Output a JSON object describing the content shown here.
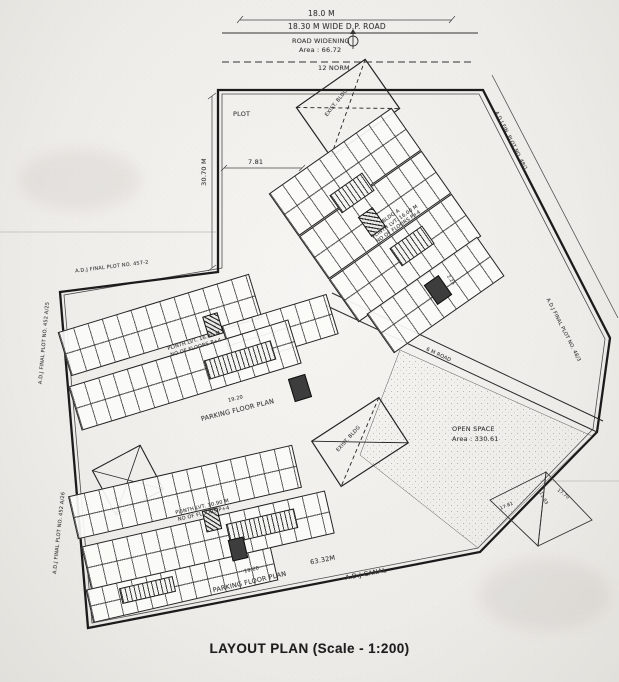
{
  "title": "LAYOUT PLAN (Scale - 1:200)",
  "roads": {
    "top_dim": "18.0 M",
    "dp_road": "18.30 M WIDE D.P. ROAD",
    "widening": "ROAD WIDENING",
    "widening_area": "Area : 66.72",
    "setback": "12 NORM",
    "internal": "6 M ROAD",
    "canal": "A.D.J CANAL",
    "canal_dim": "63.32M"
  },
  "plot": {
    "label": "PLOT",
    "west_dim": "30.70 M",
    "offset_dim": "7.81",
    "side_dim": "2.25"
  },
  "buildings": {
    "a": {
      "name": "BLDG A",
      "plinth": "PLINTH LVT. 16.00 M",
      "floors": "NO OF FLOORS P+4"
    },
    "b": {
      "plinth": "PLINTH LVT. 16.00 M",
      "floors": "NO OF FLOORS P+4"
    },
    "c": {
      "plinth": "PLINTH LVT. 10.90 M",
      "floors": "NO OF FLOORS P+4"
    }
  },
  "parking": {
    "label": "PARKING FLOOR PLAN",
    "dim": "19.20"
  },
  "open_space": {
    "label": "OPEN SPACE",
    "area": "Area : 330.61"
  },
  "existing": {
    "label": "EXIST. BLDG"
  },
  "adjacent": {
    "left_top": "A.D.J FINAL PLOT NO. 457-2",
    "left_mid": "A.D.J FINAL PLOT NO. 452 A/25",
    "left_bottom": "A.D.J FINAL PLOT NO. 452 A/26",
    "right_top": "A.D.J FIN. PLOT NO. 48/1",
    "right_mid": "A.D.J FINAL PLOT NO. 48/3"
  },
  "survey_triangle": {
    "d1": "17.81",
    "d2": "11.03",
    "d3": "17.70"
  },
  "colors": {
    "paper": "#efede9",
    "ink": "#222222",
    "core_fill": "#3d3d3d"
  }
}
